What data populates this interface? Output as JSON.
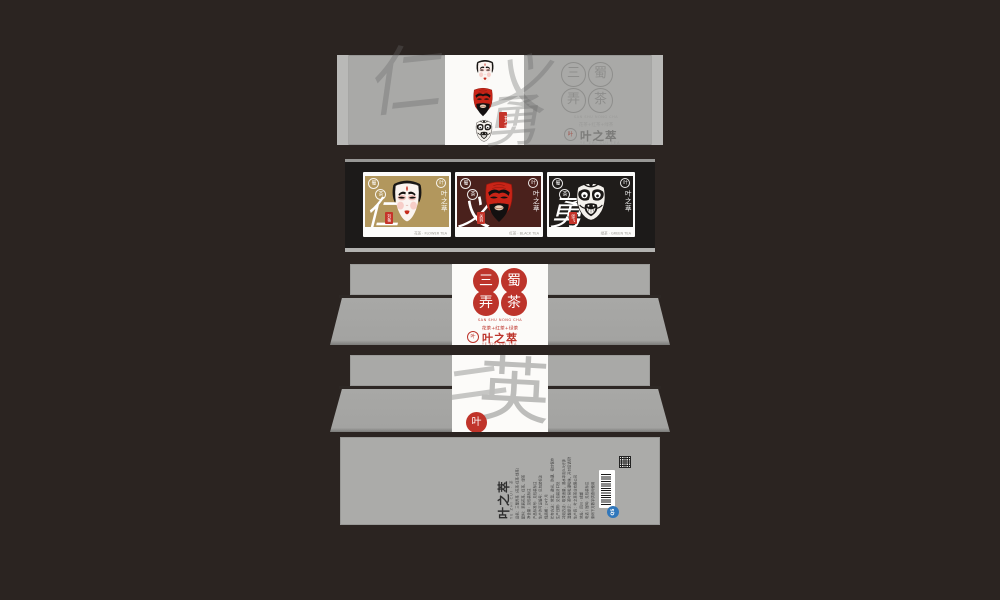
{
  "meta": {
    "title": "三蜀弄茶 · 叶之萃 tea packaging design mockup"
  },
  "colors": {
    "background": "#2b2421",
    "panel_gray": "#a9a9a7",
    "shelf_black": "#1c1a19",
    "seal_red": "#c0342a",
    "card_gold": "#b2975d",
    "card_maroon": "#4a211c",
    "card_black": "#1f1c1a",
    "qs_blue": "#3077bb"
  },
  "brand": {
    "seal_circles": [
      "三",
      "蜀",
      "弄",
      "茶"
    ],
    "latin_name": "SAN SHU NONG CHA",
    "tea_types_line": "花茶+红茶+绿茶",
    "logo": {
      "mark_char": "叶",
      "name": "叶之萃",
      "tagline": "YE ZHI CUI TEA"
    },
    "edition_seal": "珍藏版"
  },
  "lid": {
    "watermark_chars": [
      "仁",
      "义",
      "勇"
    ]
  },
  "shelf": {
    "cards": [
      {
        "tea": "花茶",
        "tea_latin": "FLOWER TEA",
        "virtue": "仁",
        "name_seal": "刘备",
        "circle_chars": [
          "蜀",
          "茶"
        ],
        "bg": "#b2975d",
        "mask": "white-face-liu-bei"
      },
      {
        "tea": "红茶",
        "tea_latin": "BLACK TEA",
        "virtue": "义",
        "name_seal": "关羽",
        "circle_chars": [
          "蜀",
          "茶"
        ],
        "bg": "#4a211c",
        "mask": "red-face-guan-yu"
      },
      {
        "tea": "绿茶",
        "tea_latin": "GREEN TEA",
        "virtue": "勇",
        "name_seal": "张飞",
        "circle_chars": [
          "蜀",
          "茶"
        ],
        "bg": "#1f1c1a",
        "mask": "black-white-face-zhang-fei"
      }
    ]
  },
  "side_panel": {
    "watermark_chars": [
      "三",
      "英"
    ],
    "seal_char": "叶"
  },
  "back_panel": {
    "logo_name": "叶之萃",
    "logo_tagline": "YE ZHI CUI · 茶",
    "qs_label": "QS",
    "info_lines": [
      "品名：三蜀弄茶（花茶·红茶·绿茶）",
      "配料：茉莉花茶、红茶、绿茶",
      "净含量：见包装标注",
      "产品标准号：见包装标注",
      "生产许可证编号：见包装标注",
      "保质期：24个月",
      "贮存方法：常温、避光、防潮、密封保存",
      "生产日期：见包装封口处",
      "冲泡方法：取茶适量，沸水冲泡3-5分钟",
      "温馨提示：茶叶易吸潮吸味，开封后请尽快饮用",
      "生产商：叶之萃茶业有限公司",
      "地址：四川 · 成都",
      "电话 / 官网：见包装标注",
      "条码下方数字供查询使用"
    ]
  }
}
